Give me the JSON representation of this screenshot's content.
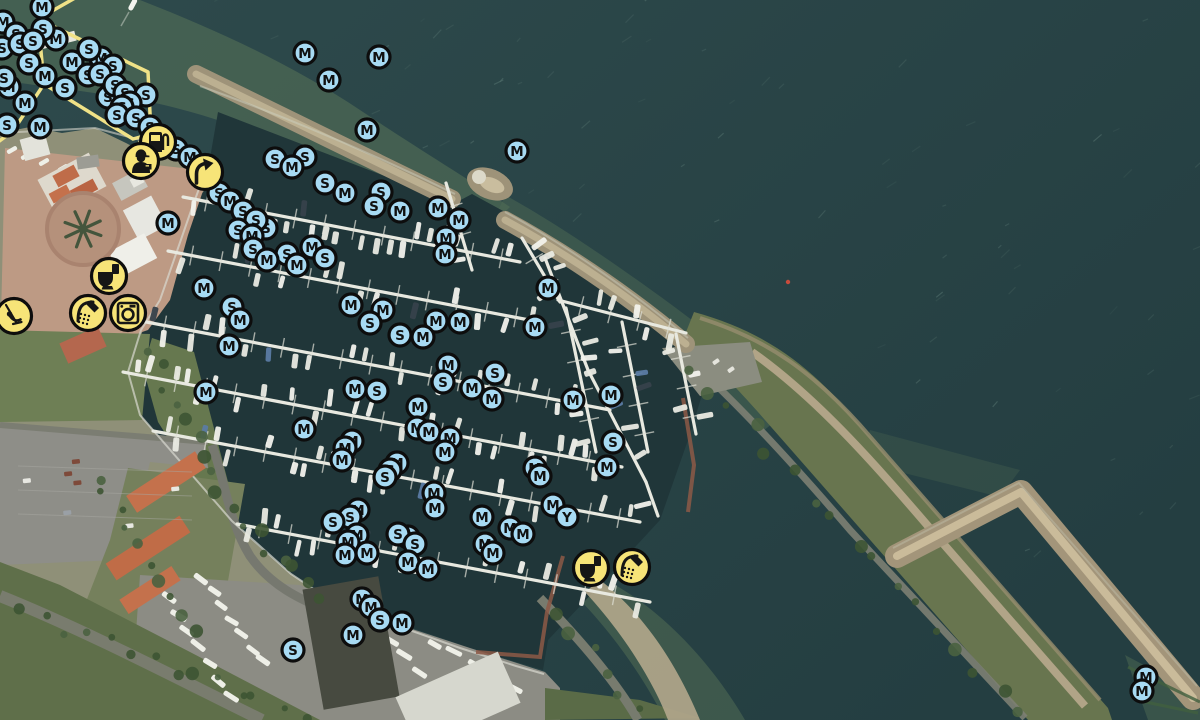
{
  "map": {
    "colors": {
      "sea": "#2c4647",
      "sea_deep": "#243e41",
      "shallow": "#4e6954",
      "basin": "#203639",
      "marker_fill": "#a7daf3",
      "marker_stroke": "#0d0d0d",
      "marker_letter": "#101010",
      "service_fill": "#f7e478",
      "service_glyph": "#161616",
      "route": "#f0e287",
      "breakwater": "#9e9379",
      "dike_grass": "#68754f",
      "sand_path": "#b1a487"
    },
    "berth_markers": [
      [
        3,
        22,
        "M"
      ],
      [
        16,
        34,
        "S"
      ],
      [
        2,
        48,
        "S"
      ],
      [
        42,
        7,
        "M"
      ],
      [
        56,
        39,
        "M"
      ],
      [
        43,
        29,
        "S"
      ],
      [
        20,
        44,
        "S"
      ],
      [
        33,
        41,
        "S"
      ],
      [
        72,
        62,
        "M"
      ],
      [
        88,
        75,
        "S"
      ],
      [
        29,
        63,
        "S"
      ],
      [
        65,
        88,
        "S"
      ],
      [
        45,
        76,
        "M"
      ],
      [
        9,
        87,
        "M"
      ],
      [
        4,
        78,
        "S"
      ],
      [
        25,
        103,
        "M"
      ],
      [
        7,
        125,
        "S"
      ],
      [
        40,
        127,
        "M"
      ],
      [
        101,
        58,
        "M"
      ],
      [
        89,
        49,
        "S"
      ],
      [
        113,
        66,
        "S"
      ],
      [
        100,
        74,
        "S"
      ],
      [
        108,
        97,
        "S"
      ],
      [
        115,
        85,
        "S"
      ],
      [
        125,
        93,
        "S"
      ],
      [
        146,
        95,
        "S"
      ],
      [
        130,
        103,
        "S"
      ],
      [
        122,
        107,
        "S"
      ],
      [
        117,
        115,
        "S"
      ],
      [
        136,
        118,
        "S"
      ],
      [
        150,
        127,
        "S"
      ],
      [
        176,
        149,
        "S"
      ],
      [
        190,
        157,
        "M"
      ],
      [
        219,
        193,
        "S"
      ],
      [
        232,
        201,
        "S"
      ],
      [
        230,
        201,
        "M"
      ],
      [
        243,
        211,
        "S"
      ],
      [
        266,
        228,
        "S"
      ],
      [
        256,
        220,
        "S"
      ],
      [
        238,
        230,
        "S"
      ],
      [
        252,
        236,
        "M"
      ],
      [
        312,
        247,
        "M"
      ],
      [
        253,
        249,
        "S"
      ],
      [
        287,
        254,
        "S"
      ],
      [
        267,
        260,
        "M"
      ],
      [
        325,
        258,
        "S"
      ],
      [
        297,
        265,
        "M"
      ],
      [
        232,
        307,
        "S"
      ],
      [
        240,
        320,
        "M"
      ],
      [
        168,
        223,
        "M"
      ],
      [
        204,
        288,
        "M"
      ],
      [
        229,
        346,
        "M"
      ],
      [
        206,
        392,
        "M"
      ],
      [
        305,
        53,
        "M"
      ],
      [
        379,
        57,
        "M"
      ],
      [
        329,
        80,
        "M"
      ],
      [
        367,
        130,
        "M"
      ],
      [
        517,
        151,
        "M"
      ],
      [
        275,
        159,
        "S"
      ],
      [
        305,
        157,
        "S"
      ],
      [
        292,
        167,
        "M"
      ],
      [
        325,
        183,
        "S"
      ],
      [
        381,
        192,
        "S"
      ],
      [
        345,
        193,
        "M"
      ],
      [
        374,
        206,
        "S"
      ],
      [
        400,
        211,
        "M"
      ],
      [
        438,
        208,
        "M"
      ],
      [
        459,
        220,
        "M"
      ],
      [
        446,
        238,
        "M"
      ],
      [
        445,
        254,
        "M"
      ],
      [
        351,
        305,
        "M"
      ],
      [
        383,
        310,
        "M"
      ],
      [
        370,
        323,
        "S"
      ],
      [
        436,
        321,
        "M"
      ],
      [
        460,
        322,
        "M"
      ],
      [
        400,
        335,
        "S"
      ],
      [
        423,
        337,
        "M"
      ],
      [
        448,
        365,
        "M"
      ],
      [
        495,
        373,
        "S"
      ],
      [
        443,
        382,
        "S"
      ],
      [
        355,
        389,
        "M"
      ],
      [
        377,
        391,
        "S"
      ],
      [
        472,
        388,
        "M"
      ],
      [
        492,
        399,
        "M"
      ],
      [
        418,
        407,
        "M"
      ],
      [
        417,
        428,
        "M"
      ],
      [
        304,
        429,
        "M"
      ],
      [
        429,
        432,
        "M"
      ],
      [
        450,
        438,
        "M"
      ],
      [
        445,
        452,
        "M"
      ],
      [
        352,
        441,
        "M"
      ],
      [
        345,
        448,
        "M"
      ],
      [
        342,
        460,
        "M"
      ],
      [
        397,
        463,
        "M"
      ],
      [
        390,
        470,
        "S"
      ],
      [
        385,
        477,
        "S"
      ],
      [
        434,
        493,
        "M"
      ],
      [
        435,
        508,
        "M"
      ],
      [
        482,
        517,
        "M"
      ],
      [
        358,
        510,
        "M"
      ],
      [
        350,
        517,
        "S"
      ],
      [
        333,
        522,
        "S"
      ],
      [
        357,
        535,
        "M"
      ],
      [
        348,
        542,
        "M"
      ],
      [
        367,
        553,
        "M"
      ],
      [
        345,
        555,
        "M"
      ],
      [
        408,
        537,
        "S"
      ],
      [
        398,
        534,
        "S"
      ],
      [
        415,
        544,
        "S"
      ],
      [
        510,
        528,
        "M"
      ],
      [
        523,
        534,
        "M"
      ],
      [
        485,
        544,
        "M"
      ],
      [
        493,
        553,
        "M"
      ],
      [
        548,
        288,
        "M"
      ],
      [
        535,
        327,
        "M"
      ],
      [
        611,
        395,
        "M"
      ],
      [
        573,
        400,
        "M"
      ],
      [
        613,
        442,
        "S"
      ],
      [
        535,
        468,
        "M"
      ],
      [
        540,
        476,
        "M"
      ],
      [
        607,
        467,
        "M"
      ],
      [
        553,
        505,
        "M"
      ],
      [
        567,
        517,
        "Y"
      ],
      [
        408,
        562,
        "M"
      ],
      [
        428,
        569,
        "M"
      ],
      [
        362,
        599,
        "M"
      ],
      [
        371,
        607,
        "M"
      ],
      [
        380,
        620,
        "S"
      ],
      [
        402,
        623,
        "M"
      ],
      [
        353,
        635,
        "M"
      ],
      [
        293,
        650,
        "S"
      ],
      [
        1146,
        677,
        "M"
      ],
      [
        1142,
        691,
        "M"
      ]
    ],
    "service_markers": [
      [
        158,
        142,
        "fuel"
      ],
      [
        141,
        161,
        "harbormaster"
      ],
      [
        205,
        172,
        "slipway"
      ],
      [
        109,
        276,
        "toilet"
      ],
      [
        88,
        313,
        "shower"
      ],
      [
        128,
        313,
        "laundry"
      ],
      [
        14,
        316,
        "playground"
      ],
      [
        591,
        568,
        "toilet"
      ],
      [
        632,
        567,
        "shower"
      ]
    ],
    "route": {
      "paths": [
        "M75,-2 L38,19 L148,72 L151,134 L140,142",
        "M38,19 L44,84 L13,131 L-2,142",
        "M44,84 L133,139 L151,134"
      ]
    }
  }
}
